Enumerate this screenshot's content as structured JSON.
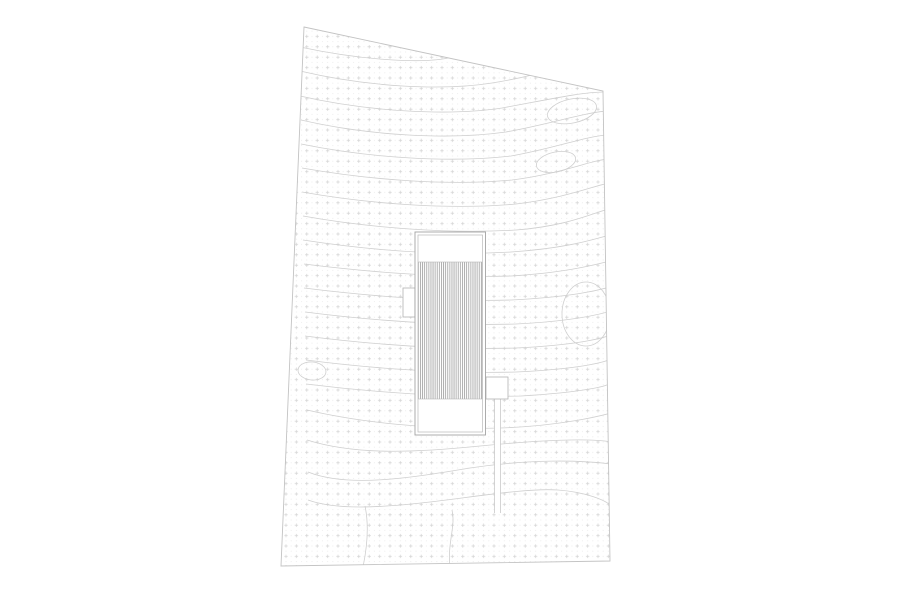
{
  "canvas": {
    "width": 900,
    "height": 600,
    "background": "#ffffff"
  },
  "site": {
    "boundary_points": "304,27 603,91 610,561 281,566",
    "boundary_color": "#c3c3c3",
    "texture": {
      "grid_spacing": 10.4,
      "plus_half": 1.7,
      "plus_stroke": 0.7,
      "plus_color": "#d3d3d3",
      "subdot_radius": 0.5,
      "subdot_color": "#e7e7e7"
    },
    "contour_color": "#cfcfcf",
    "contour_width": 0.8,
    "contours": [
      "M300,47 C365,61 428,64 452,57 C470,52 480,46 488,40",
      "M300,71 C368,87 442,91 492,83 C535,76 556,68 570,64",
      "M300,96 C370,112 450,116 502,108 C546,100 582,92 604,92",
      "M301,120 C370,136 450,140 506,132 C551,124 586,112 608,111",
      "M301,144 C370,158 450,163 511,156 C556,148 586,136 608,135",
      "M302,168 C370,180 450,186 512,180 C561,174 591,160 609,159",
      "M302,192 C370,204 450,210 516,204 C566,198 593,186 609,183",
      "M303,216 C370,228 450,234 516,230 C569,226 595,212 609,209",
      "M303,240 C368,250 440,256 511,252 C571,248 597,238 610,235",
      "M304,264 C368,272 440,278 511,276 C571,272 597,264 610,261",
      "M304,288 C368,296 440,302 511,300 C573,297 599,290 610,287",
      "M305,312 C368,320 445,326 516,324 C576,321 601,314 611,311",
      "M305,336 C368,344 445,350 516,348 C579,345 603,338 611,335",
      "M306,360 C368,368 445,374 516,372 C581,369 605,362 611,359",
      "M306,384 C370,392 450,398 521,396 C586,392 607,386 611,383",
      "M307,410 C358,422 430,430 500,428 C560,426 600,416 611,413",
      "M307,440 C358,456 420,452 480,446 C540,440 590,438 611,442",
      "M308,472 C348,488 410,478 470,468 C530,459 580,460 611,464",
      "M308,500 C336,510 378,508 430,502 C480,496 528,488 558,490 C585,492 606,500 611,506",
      "M365,506 C368,520 369,538 363,567",
      "M452,510 C456,526 447,544 450,567"
    ],
    "closed_contours": [
      {
        "cx": 572,
        "cy": 111,
        "rx": 25,
        "ry": 12,
        "rotate": -12
      },
      {
        "cx": 556,
        "cy": 162,
        "rx": 20,
        "ry": 10,
        "rotate": -12
      },
      {
        "cx": 312,
        "cy": 371,
        "rx": 14,
        "ry": 9,
        "rotate": 5
      },
      {
        "cx": 586,
        "cy": 314,
        "rx": 24,
        "ry": 32,
        "rotate": 0
      }
    ]
  },
  "building": {
    "outline_color": "#a3a3a3",
    "inner_color": "#bababa",
    "fill": "#ffffff",
    "outer": {
      "x": 415,
      "y": 232,
      "w": 70.5,
      "h": 203
    },
    "inner": {
      "x": 418,
      "y": 235,
      "w": 64.5,
      "h": 197
    },
    "hatch": {
      "x": 418.5,
      "y": 262,
      "w": 63.5,
      "h": 137,
      "spacing": 2.1,
      "line_width": 0.9,
      "color": "#a8a8a8",
      "border_color": "#b8b8b8"
    },
    "left_annex": {
      "x": 403,
      "y": 288,
      "w": 12,
      "h": 29
    },
    "right_annex": {
      "x": 486,
      "y": 377,
      "w": 22,
      "h": 22
    },
    "annex_color": "#b3b3b3"
  },
  "driveway": {
    "x": 494.5,
    "y": 399,
    "w": 6,
    "h": 114,
    "color": "#c9c9c9"
  }
}
